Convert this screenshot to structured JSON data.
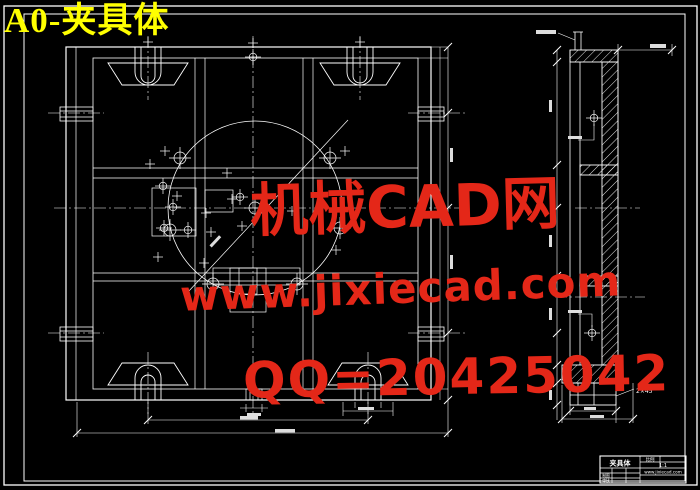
{
  "page": {
    "background_color": "#000000",
    "line_color": "#ffffff",
    "title_color": "#ffff00",
    "watermark_color": "#e42718"
  },
  "title": {
    "text": "A0-夹具体"
  },
  "watermark": {
    "lines": [
      {
        "text": "机械CAD网"
      },
      {
        "text": "www.jixiecad.com"
      },
      {
        "text": "QQ=20425042"
      }
    ]
  },
  "views": {
    "front_view": {
      "name": "fixture-body-front-view"
    },
    "section_view": {
      "name": "fixture-body-section-view",
      "chamfer_label": "2×45°"
    }
  },
  "title_block": {
    "part_name": "夹具体",
    "scale_label": "比例",
    "scale_value": "1:1",
    "info_text": "www.jixiecad.com",
    "row_labels": [
      "制图",
      "审核"
    ]
  }
}
